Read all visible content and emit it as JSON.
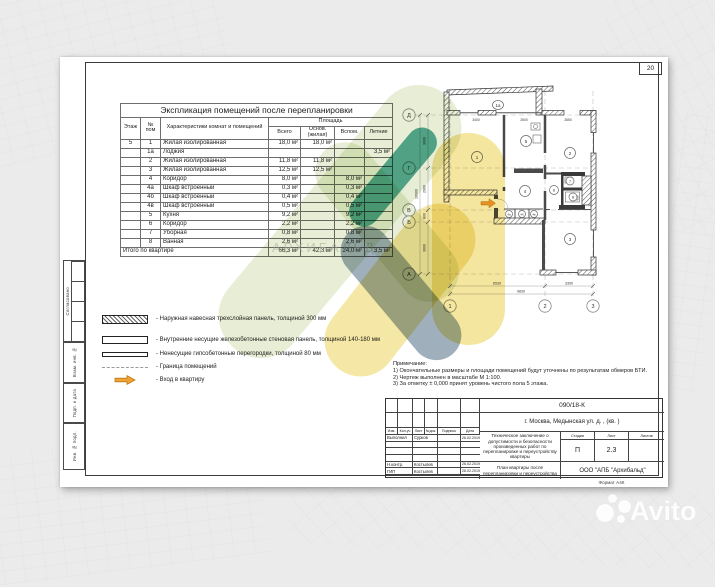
{
  "page": {
    "number": "20",
    "format_note": "Формат А4К"
  },
  "side_stamp": {
    "approved": "Согласовано",
    "vzam": "Взам. инв. №",
    "podp": "Подп. и дата",
    "inv": "Инв. № подл."
  },
  "watermark": {
    "brand": "АРХИБАЛЬД"
  },
  "avito": {
    "label": "Avito"
  },
  "explication": {
    "title": "Экспликация помещений после перепланировки",
    "headers": {
      "floor": "Этаж",
      "room_no": "№ пом",
      "desc": "Характеристики комнат и помещений",
      "area": "Площадь",
      "total": "Всего",
      "main": "Основ. (жилая)",
      "aux": "Вспом.",
      "summer": "Летние"
    },
    "rows": [
      {
        "floor": "5",
        "num": "1",
        "name": "Жилая изолированная",
        "total": "18,0 м²",
        "main": "18,0 м²",
        "aux": "",
        "summer": ""
      },
      {
        "floor": "",
        "num": "1а",
        "name": "Лоджия",
        "total": "",
        "main": "",
        "aux": "",
        "summer": "3,5 м²"
      },
      {
        "floor": "",
        "num": "2",
        "name": "Жилая изолированная",
        "total": "11,8 м²",
        "main": "11,8 м²",
        "aux": "",
        "summer": ""
      },
      {
        "floor": "",
        "num": "3",
        "name": "Жилая изолированная",
        "total": "12,5 м²",
        "main": "12,5 м²",
        "aux": "",
        "summer": ""
      },
      {
        "floor": "",
        "num": "4",
        "name": "Коридор",
        "total": "8,0 м²",
        "main": "",
        "aux": "8,0 м²",
        "summer": ""
      },
      {
        "floor": "",
        "num": "4а",
        "name": "Шкаф встроенный",
        "total": "0,3 м²",
        "main": "",
        "aux": "0,3 м²",
        "summer": ""
      },
      {
        "floor": "",
        "num": "4б",
        "name": "Шкаф встроенный",
        "total": "0,4 м²",
        "main": "",
        "aux": "0,4 м²",
        "summer": ""
      },
      {
        "floor": "",
        "num": "4в",
        "name": "Шкаф встроенный",
        "total": "0,5 м²",
        "main": "",
        "aux": "0,5 м²",
        "summer": ""
      },
      {
        "floor": "",
        "num": "5",
        "name": "Кухня",
        "total": "9,2 м²",
        "main": "",
        "aux": "9,2 м²",
        "summer": ""
      },
      {
        "floor": "",
        "num": "6",
        "name": "Коридор",
        "total": "2,2 м²",
        "main": "",
        "aux": "2,2 м²",
        "summer": ""
      },
      {
        "floor": "",
        "num": "7",
        "name": "Уборная",
        "total": "0,8 м²",
        "main": "",
        "aux": "0,8 м²",
        "summer": ""
      },
      {
        "floor": "",
        "num": "8",
        "name": "Ванная",
        "total": "2,6 м²",
        "main": "",
        "aux": "2,6 м²",
        "summer": ""
      }
    ],
    "total_label": "Итого по квартире",
    "totals": {
      "total": "66,3 м²",
      "main": "42,3 м²",
      "aux": "24,0 м²",
      "summer": "3,5 м²"
    }
  },
  "legend": {
    "items": [
      {
        "label": "-  Наружная навесная трехслойная панель, толщиной 300 мм"
      },
      {
        "label": "-  Внутренние несущие железобетонные стеновая панель, толщиной 140-180 мм"
      },
      {
        "label": "-  Ненесущие гипсобетонные  перегородки, толщиной 80 мм"
      },
      {
        "label": "-  Граница помещений"
      },
      {
        "label": "-  Вход в квартиру"
      }
    ]
  },
  "plan": {
    "axis_rows": [
      "Д",
      "Г",
      "В",
      "Б",
      "А"
    ],
    "axis_cols": [
      "1",
      "2",
      "3"
    ],
    "rooms": {
      "loggia": "1а",
      "r1": "1",
      "r5": "5",
      "r2": "2",
      "r4": "4",
      "r6": "6",
      "r7": "7",
      "r8": "8",
      "r3": "3",
      "c4a": "4а",
      "c4b": "4б",
      "c4v": "4в"
    },
    "dims": {
      "top": [
        "3400",
        "2600",
        "2650"
      ],
      "left": [
        "3600",
        "2900",
        "800",
        "3600"
      ],
      "left_total": "10900",
      "bottom": [
        "6530",
        "3300"
      ],
      "bottom_total": "9830"
    }
  },
  "notes": {
    "title": "Примечание:",
    "items": [
      "1) Окончательные размеры и площади помещений будут уточнены по результатам обмеров БТИ.",
      "2) Чертеж выполнен в масштабе  М 1:100.",
      "3) За отметку ± 0,000 принят уровень чистого пола 5 этажа."
    ]
  },
  "title_block": {
    "code": "090/18-К",
    "address": "г. Москва, Медынская ул. д.     , (кв.     )",
    "cols": [
      "Изм.",
      "Кол.уч",
      "Лист",
      "№док.",
      "Подпись",
      "Дата"
    ],
    "sign_rows": [
      {
        "role": "Выполнил",
        "name": "Сурков",
        "date": "26.02.2019"
      },
      {
        "role": "",
        "name": "",
        "date": ""
      },
      {
        "role": "",
        "name": "",
        "date": ""
      },
      {
        "role": "",
        "name": "",
        "date": ""
      },
      {
        "role": "Н.контр.",
        "name": "Костылев",
        "date": "26.02.2019"
      },
      {
        "role": "ГИП",
        "name": "Костылев",
        "date": "26.02.2019"
      }
    ],
    "doc_title": "Техническое заключение о допустимости и безопасности произведенных работ по перепланировке и переустройству квартиры",
    "stage_label": "Стадия",
    "sheet_label": "Лист",
    "sheets_label": "Листов",
    "stage": "П",
    "sheet": "2.3",
    "sheets": "",
    "drawing_title": "План квартиры после перепланировки и переустройства",
    "company": "ООО \"АПБ \"Архибальд\""
  }
}
